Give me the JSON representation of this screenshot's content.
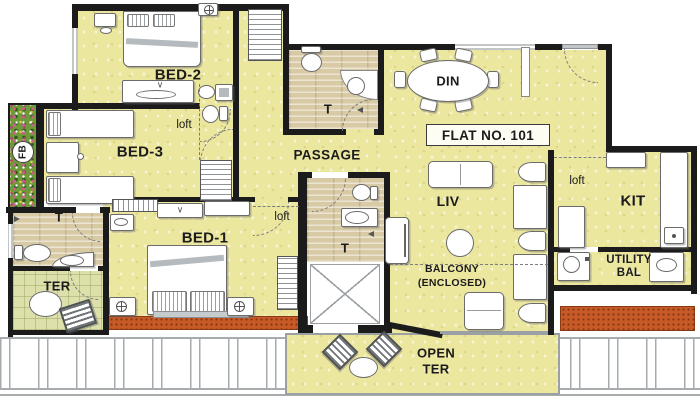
{
  "flat": {
    "number_label": "FLAT NO. 101"
  },
  "rooms": {
    "bed1": "BED-1",
    "bed2": "BED-2",
    "bed3": "BED-3",
    "din": "DIN",
    "liv": "LIV",
    "kit": "KIT",
    "passage": "PASSAGE",
    "toilet": "T",
    "terrace": "TER",
    "open_terrace_l1": "OPEN",
    "open_terrace_l2": "TER",
    "balcony_l1": "BALCONY",
    "balcony_l2": "(ENCLOSED)",
    "utility_l1": "UTILITY",
    "utility_l2": "BAL",
    "flower_bed": "FB",
    "loft": "loft"
  },
  "icons": {
    "mirror_mark": "∨"
  },
  "colors": {
    "wall": "#1b1b1b",
    "room_fill": "#ece79f",
    "toilet_fill": "#d8caa5",
    "terrace_fill": "#dde0ab",
    "brick_planter": "#c85a28",
    "flower_bed": "#6f9a3c",
    "railing": "#a6abae"
  }
}
